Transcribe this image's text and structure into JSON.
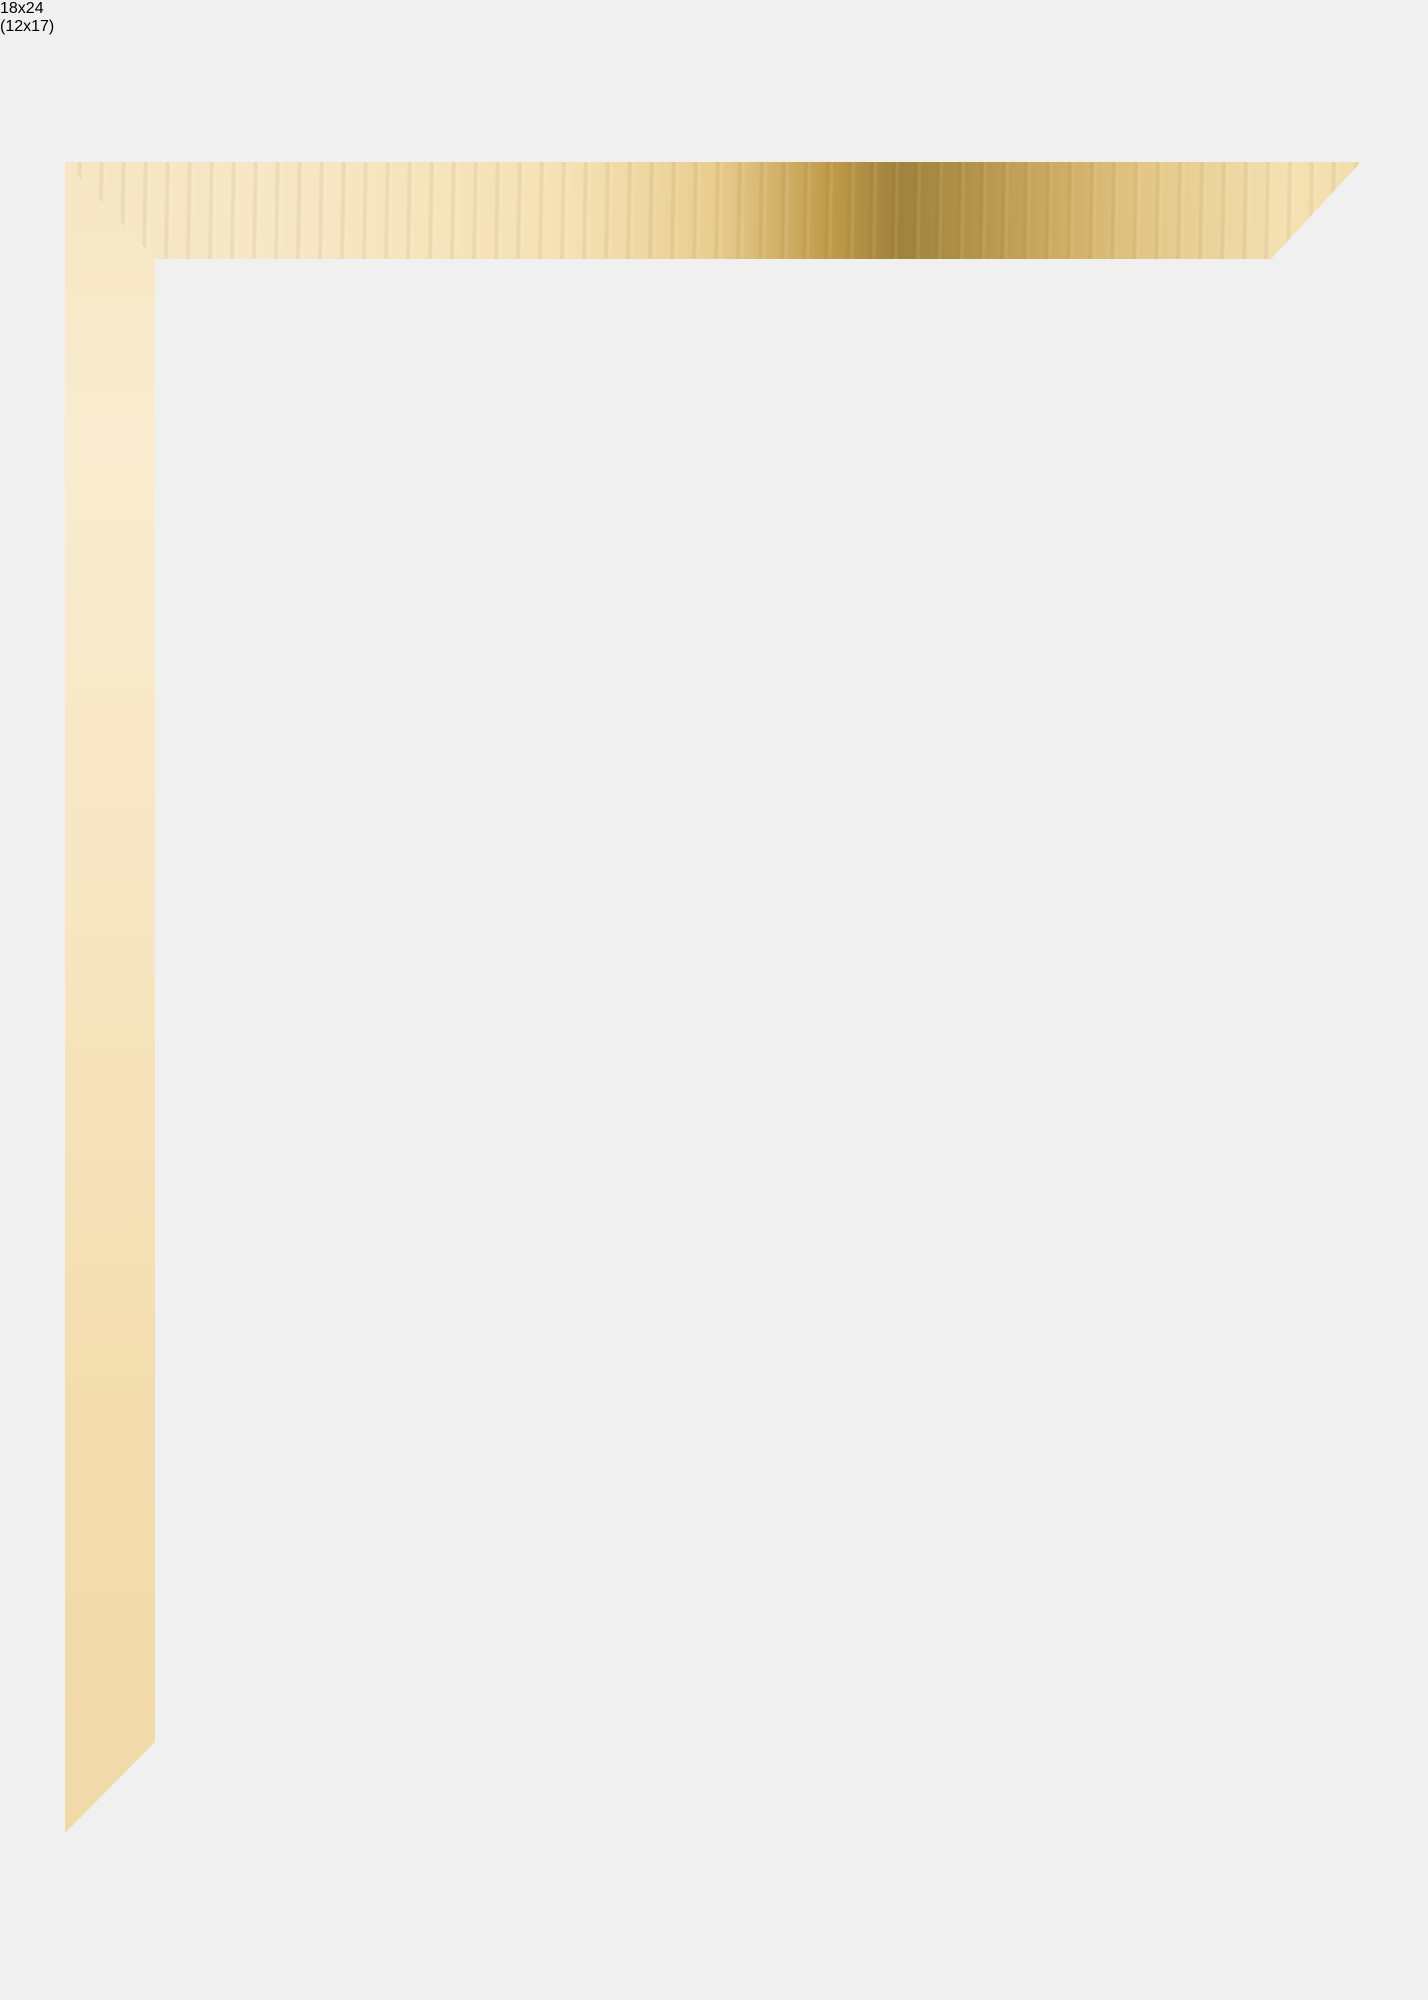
{
  "image": {
    "type": "picture-frame-product-photo",
    "frame_size_label": "18x24",
    "picture_size_label": "(12x17)",
    "colors": {
      "background": "#f0f0f1",
      "frame_gold_light": "#f7e7c6",
      "frame_gold_glare": "#9a8142",
      "sample_gold_matte": "#d4ba8a",
      "sample_gold_side": "#a5885a",
      "mat_white": "#fbfbfc",
      "opening_gray": "#edeeef",
      "text_black": "#0d0d0d"
    }
  }
}
